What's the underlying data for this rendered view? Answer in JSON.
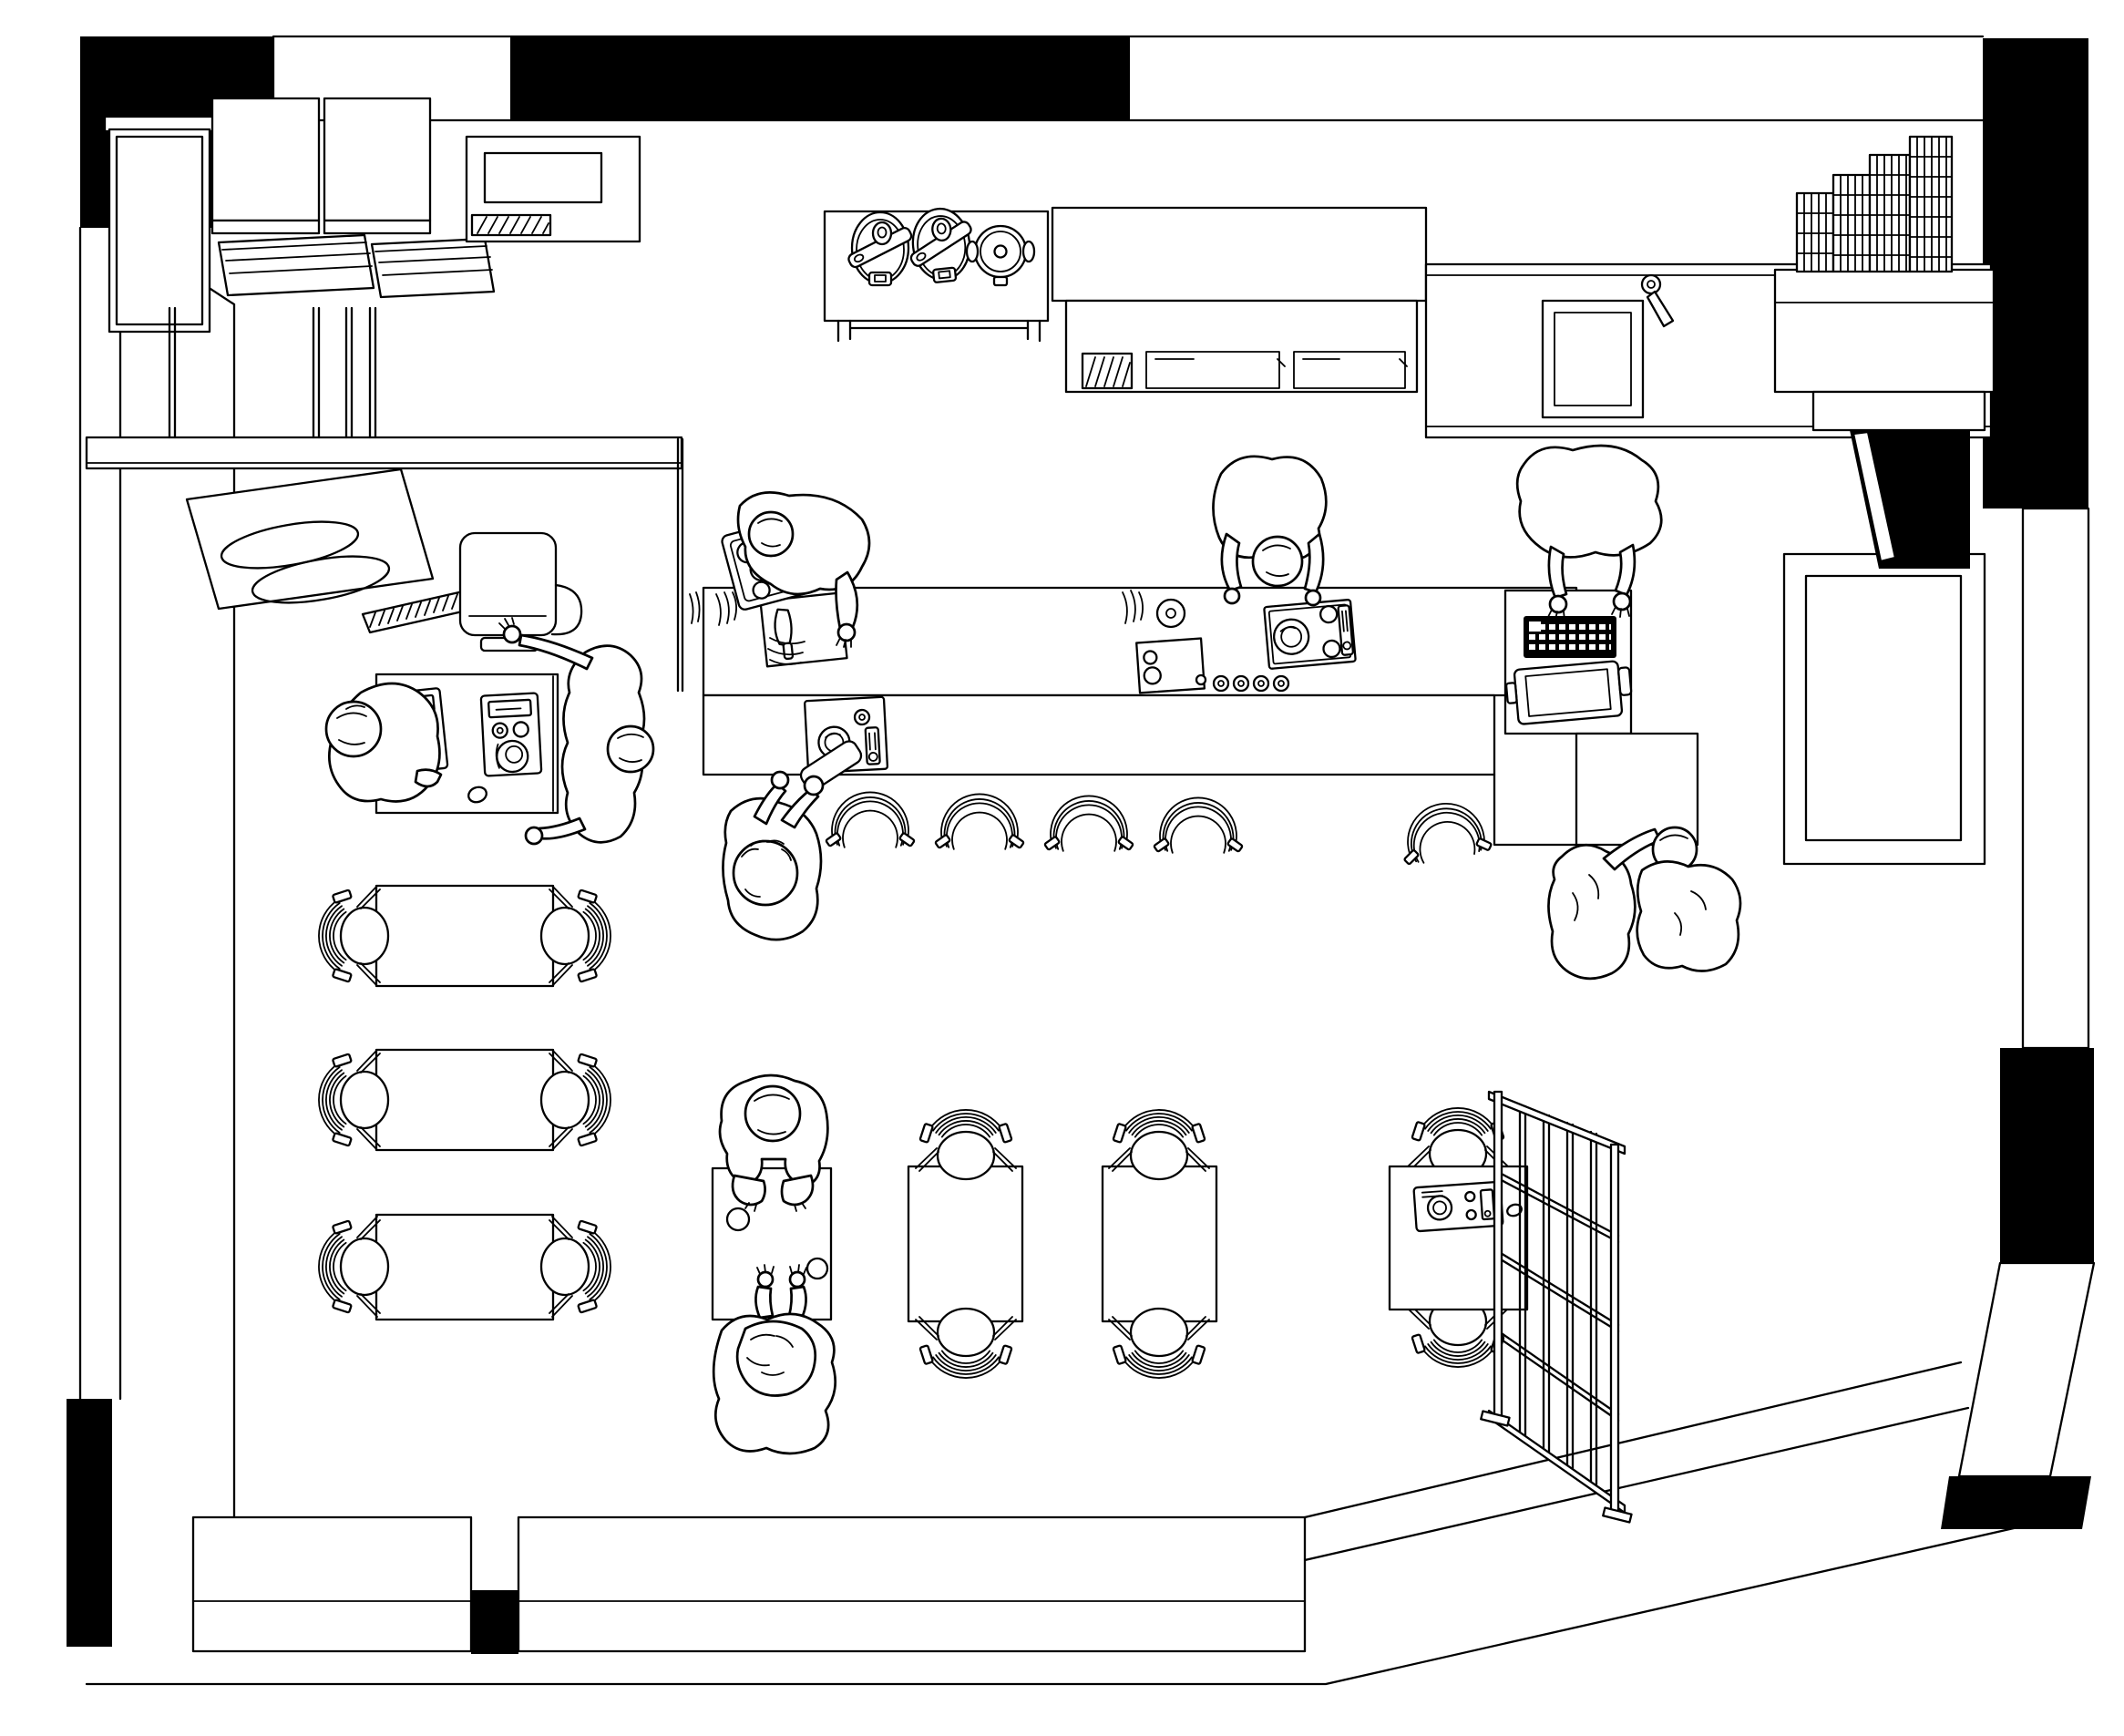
{
  "document": {
    "kind": "monochrome line drawing",
    "view": "axonometric top-down floor plan",
    "subject": "restaurant interior with open kitchen, bar counter and dining room",
    "aria_label": "Black-and-white axonometric floor plan drawing of a small restaurant: kitchen appliances along the top wall, a central island and bar counter with staff and seated customers, a coffee station on the left, dining tables with slatted chairs below, and a lattice partition screen at the lower right"
  },
  "palette": {
    "line": "#000000",
    "background": "#ffffff",
    "wall_fill": "#000000"
  },
  "counts": {
    "people": 10,
    "dining_tables": 7,
    "dining_chairs": 12,
    "bar_stools": 5,
    "rice_cookers": 2,
    "stock_pots": 1,
    "espresso_machines": 2,
    "wire_crate_stacks": 4
  },
  "objects": {
    "walls": {
      "label": "structural walls with solid black piers"
    },
    "tall_cabinet": {
      "label": "tall refrigerator cabinet"
    },
    "wall_boxes": {
      "label": "two box cabinets with tray shelves"
    },
    "vented_appliance": {
      "label": "vented counter appliance"
    },
    "cooker_table": {
      "label": "prep table with two rice cookers and a stock pot"
    },
    "worktop_fridge": {
      "label": "worktop refrigerator with two drawers"
    },
    "sink_counter": {
      "label": "back counter with sink and faucet"
    },
    "crate_counter": {
      "label": "corner counter with stacked wire crates"
    },
    "doorway": {
      "label": "dark doorway opening"
    },
    "pass_shelf": {
      "label": "service pass shelf and partition"
    },
    "hood_unit": {
      "label": "ventilation hood with coils and grille"
    },
    "grinder_box": {
      "label": "counter appliance beside hood"
    },
    "coffee_station": {
      "label": "coffee table with two espresso machines"
    },
    "island": {
      "label": "kitchen island work counter"
    },
    "bar_counter": {
      "label": "front bar counter"
    },
    "cutting_board": {
      "label": "cutting board with knife"
    },
    "produce_basket": {
      "label": "basket of produce"
    },
    "island_hob": {
      "label": "portable induction hob"
    },
    "bar_hob": {
      "label": "bar-top burner console"
    },
    "pos_terminal": {
      "label": "cash register with keyboard and screen tray"
    },
    "stools": {
      "label": "bar stools"
    },
    "window_bay": {
      "label": "window bay in right wall"
    },
    "benches": {
      "label": "low window benches along bottom wall"
    },
    "partition_screen": {
      "label": "wooden lattice partition screen"
    },
    "table_cooker": {
      "label": "tabletop grill console"
    }
  },
  "people": [
    {
      "id": "staff-prep",
      "label": "cook sorting produce over the island"
    },
    {
      "id": "staff-bowing",
      "label": "cook leaning over the island hob"
    },
    {
      "id": "staff-pos",
      "label": "staff member typing at the register"
    },
    {
      "id": "staff-coffee-left",
      "label": "barista bent over coffee machine"
    },
    {
      "id": "staff-coffee-right",
      "label": "barista reaching across coffee station"
    },
    {
      "id": "customer-drinker",
      "label": "seated customer drinking at the bar"
    },
    {
      "id": "customer-couple-1",
      "label": "customer seated at counter end"
    },
    {
      "id": "customer-couple-2",
      "label": "companion seated at counter end"
    },
    {
      "id": "diner-top",
      "label": "diner seated at center table"
    },
    {
      "id": "diner-bottom",
      "label": "diner seated opposite at center table"
    }
  ]
}
